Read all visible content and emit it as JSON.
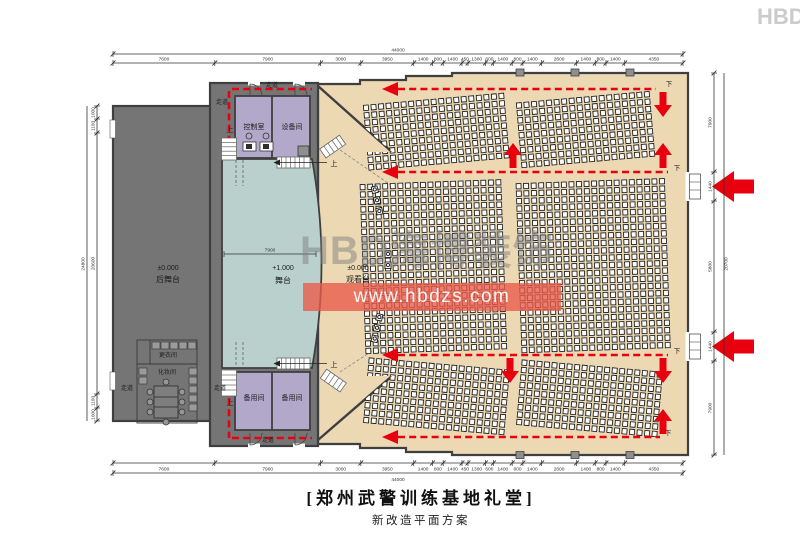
{
  "title": {
    "main": "[郑州武警训练基地礼堂]",
    "sub": "新改造平面方案"
  },
  "watermark": {
    "logo": "HBD",
    "brand": "海博装饰",
    "url": "www.hbdzs.com",
    "corner": "HBD"
  },
  "rooms": {
    "backstage_level": "±0.000",
    "backstage": "后舞台",
    "stage_level": "+1.000",
    "stage": "舞台",
    "audience_level": "±0.000",
    "audience": "观看台",
    "control_room": "控制室",
    "equipment_room": "设备间",
    "spare_room_left": "备用间",
    "spare_room_right": "备用间",
    "changing_room": "更衣间",
    "makeup_room": "化妆间",
    "corridor": "走道"
  },
  "markers": {
    "up": "上",
    "down": "下"
  },
  "dimensions": {
    "overall_width": "44000",
    "top_segments": [
      "7600",
      "7900",
      "3000",
      "3950",
      "1400",
      "800",
      "1400",
      "450",
      "1300",
      "600",
      "1400",
      "800",
      "1400",
      "2600",
      "1400",
      "800",
      "1400",
      "4350"
    ],
    "bottom_segments": [
      "7600",
      "7900",
      "3000",
      "3950",
      "1400",
      "800",
      "1400",
      "450",
      "1300",
      "600",
      "1400",
      "800",
      "1400",
      "2600",
      "1400",
      "800",
      "1400",
      "4350"
    ],
    "left_segments": [
      "1000",
      "1100",
      "20600",
      "1100",
      "1000"
    ],
    "left_total": "24800",
    "right_segments": [
      "7900",
      "1440",
      "5800",
      "1440",
      "7900"
    ],
    "right_total": "20700",
    "stage_width": "7900"
  },
  "seating": {
    "blocks": [
      {
        "id": "upper-left",
        "rows": 9,
        "cols": 19
      },
      {
        "id": "upper-right",
        "rows": 9,
        "cols": 18
      },
      {
        "id": "main-left",
        "rows": 23,
        "cols": 19
      },
      {
        "id": "main-right",
        "rows": 23,
        "cols": 20
      },
      {
        "id": "lower-left",
        "rows": 9,
        "cols": 19
      },
      {
        "id": "lower-right",
        "rows": 9,
        "cols": 19
      }
    ],
    "total_seats": 1572,
    "vip_seats": 8
  },
  "colors": {
    "backstage": "#757575",
    "stage": "#b9d0cd",
    "hall": "#ecd9b4",
    "rooms": "#b2a9ca",
    "route": "#e8000f",
    "wall": "#3f3f3f"
  }
}
